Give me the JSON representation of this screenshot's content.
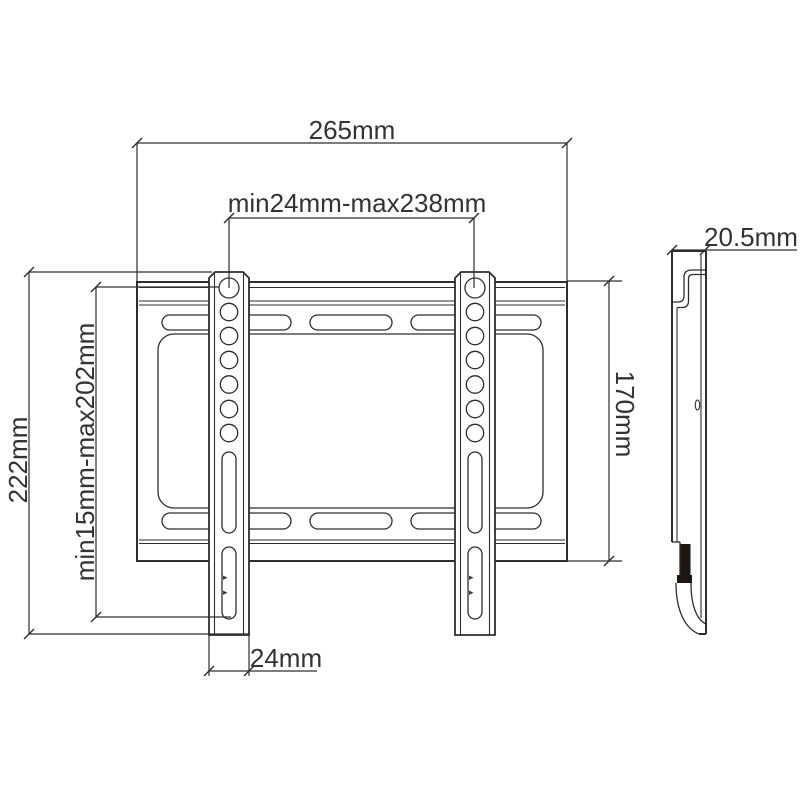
{
  "dimensions": {
    "overall_width": {
      "label": "265mm"
    },
    "horizontal_hole_range": {
      "label": "min24mm-max238mm"
    },
    "overall_height": {
      "label": "222mm"
    },
    "vertical_hole_range": {
      "label": "min15mm-max202mm"
    },
    "plate_height": {
      "label": "170mm"
    },
    "rail_width": {
      "label": "24mm"
    },
    "side_depth": {
      "label": "20.5mm"
    }
  },
  "colors": {
    "line": "#2e2e2e",
    "label": "#333333",
    "bg": "#ffffff"
  }
}
